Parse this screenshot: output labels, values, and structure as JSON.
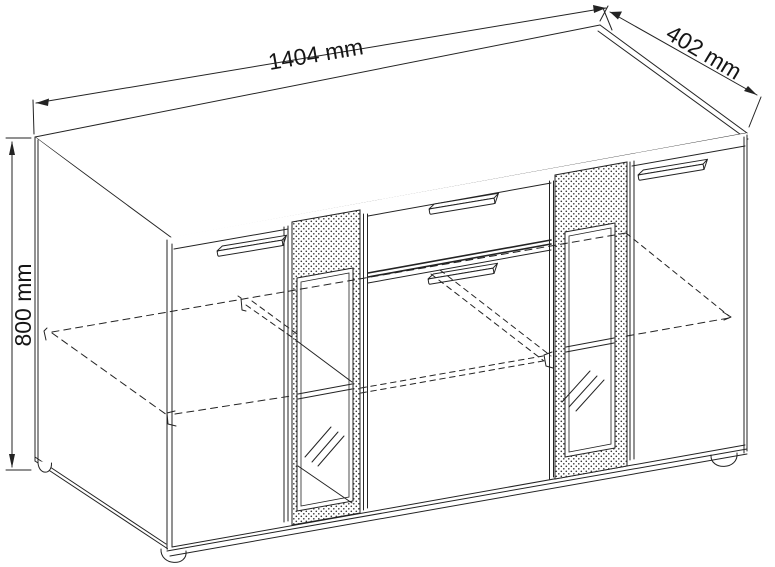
{
  "drawing": {
    "width_dim": "1404 mm",
    "depth_dim": "402 mm",
    "height_dim": "800 mm"
  },
  "colors": {
    "line": "#232323",
    "background": "#ffffff",
    "hatch_dot": "#333333"
  }
}
